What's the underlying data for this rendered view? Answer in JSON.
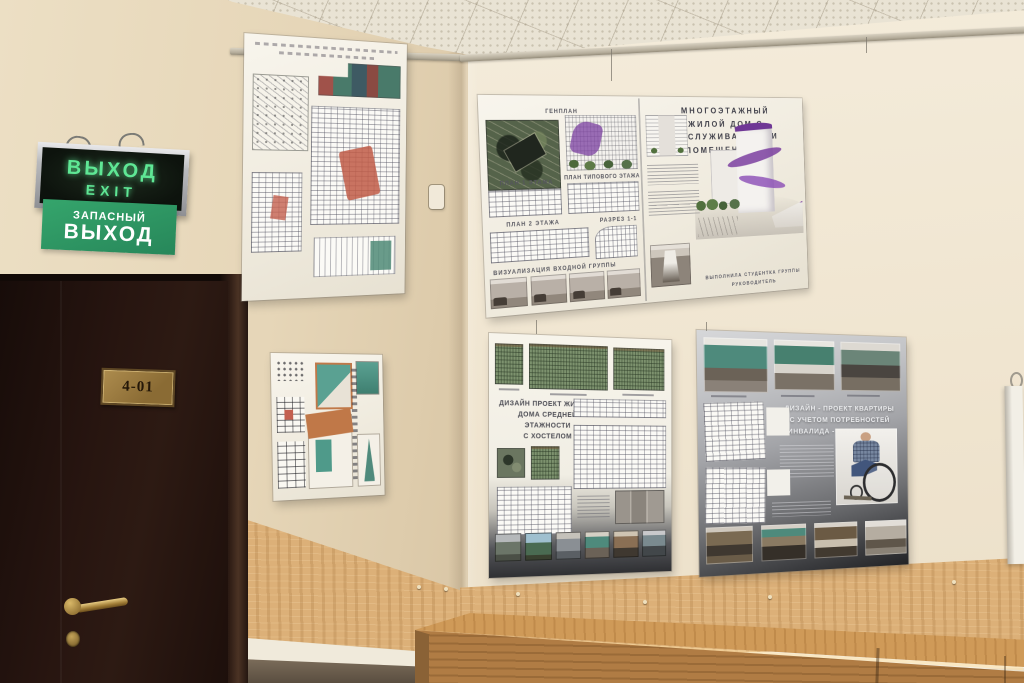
{
  "signs": {
    "exit_lightbox": {
      "line1": "ВЫХОД",
      "line2": "EXIT"
    },
    "emergency_exit": {
      "line1": "ЗАПАСНЫЙ",
      "line2": "ВЫХОД"
    }
  },
  "door": {
    "plaque": "4-01"
  },
  "posters": {
    "multistory_house": {
      "title": "МНОГОЭТАЖНЫЙ\nЖИЛОЙ ДОМ С\nОБСЛУЖИВАЮЩИМИ\nПОМЕЩЕНИЯМИ",
      "label_genplan": "ГЕНПЛАН",
      "label_plan1": "ПЛАН 1 ЭТАЖА",
      "label_plan_typical": "ПЛАН ТИПОВОГО ЭТАЖА",
      "label_plan2": "ПЛАН 2 ЭТАЖА",
      "label_section": "РАЗРЕЗ 1-1",
      "label_visualization": "ВИЗУАЛИЗАЦИЯ ВХОДНОЙ ГРУППЫ",
      "credits_line1": "ВЫПОЛНИЛА СТУДЕНТКА ГРУППЫ",
      "credits_line2": "РУКОВОДИТЕЛЬ"
    },
    "hostel_house": {
      "title": "ДИЗАЙН ПРОЕКТ ЖИЛОГО\nДОМА СРЕДНЕЙ ЭТАЖНОСТИ\nС ХОСТЕЛОМ"
    },
    "wheelchair_apartment": {
      "title": "ДИЗАЙН - ПРОЕКТ КВАРТИРЫ\nС УЧЕТОМ ПОТРЕБНОСТЕЙ\nИНВАЛИДА - КОЛЯСОЧНИКА"
    }
  },
  "colors": {
    "wall_left": "#e7d7bc",
    "wall_right": "#f1e7d3",
    "ceiling": "#e9e3d4",
    "door": "#271510",
    "wainscot_wood": "#dcb078",
    "desk_top": "#cf9a58",
    "exit_text_green": "#5fe795",
    "emergency_sign_green": "#2c9a62",
    "poster_paper": "#f4f1e8",
    "accent_purple": "#7b3fa0",
    "dark_poster_bg": "#3a3b3e"
  }
}
